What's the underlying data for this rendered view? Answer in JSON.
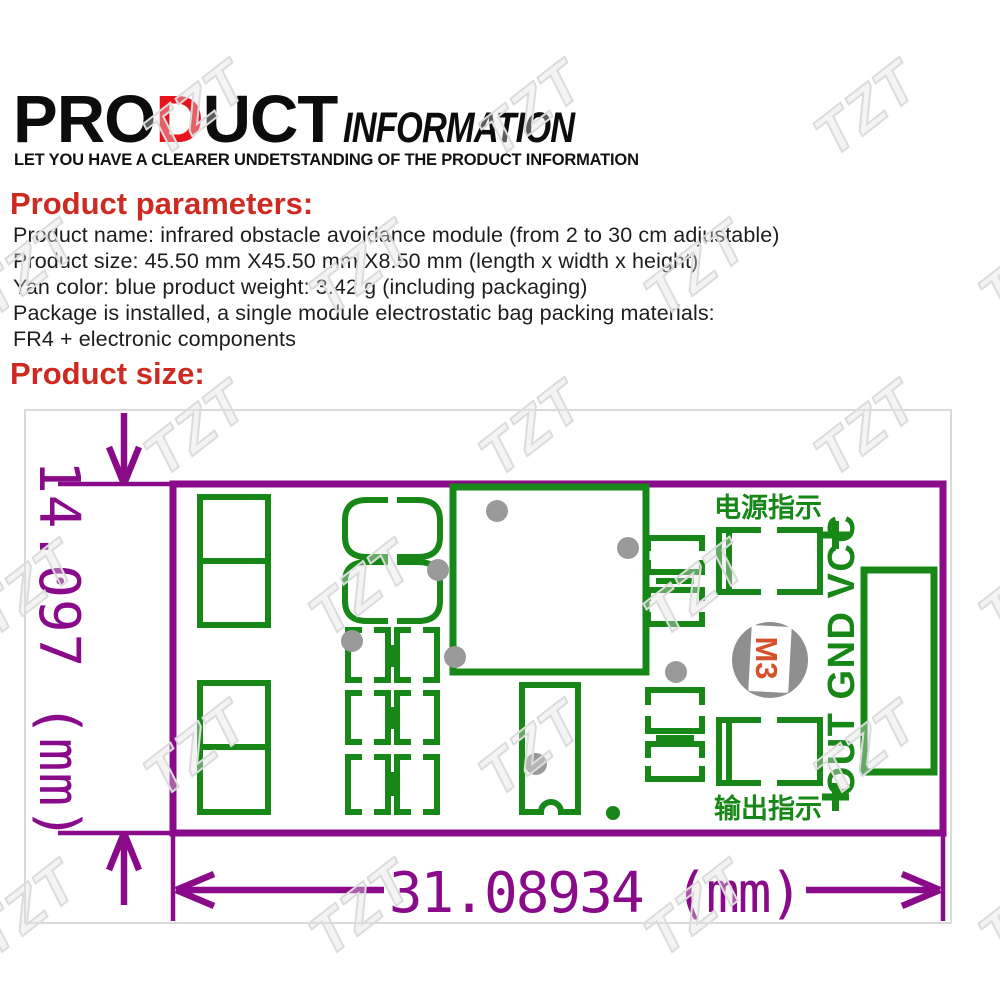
{
  "page": {
    "header": {
      "title_part1": "PRO",
      "title_accent": "D",
      "title_part2": "UCT",
      "title_secondary": "INFORMATION",
      "subtitle": "LET YOU HAVE A CLEARER UNDETSTANDING OF THE PRODUCT INFORMATION"
    },
    "parameters": {
      "heading": "Product parameters:",
      "lines": [
        "Product name: infrared obstacle avoidance module (from 2 to 30 cm adjustable)",
        "Product size: 45.50 mm X45.50 mm X8.50 mm (length x width x height)",
        "Yan color: blue product weight: 3.42 g (including packaging)",
        "Package is installed, a single module electrostatic bag packing materials:",
        "FR4 + electronic components"
      ]
    },
    "size_section": {
      "heading": "Product size:"
    },
    "diagram": {
      "height_dimension": "14.097 (mm)",
      "width_dimension": "31.08934 (mm)",
      "power_indicator_label": "电源指示",
      "output_indicator_label": "输出指示",
      "pin_labels": "OUT GND VCC",
      "mounting_hole_label": "M3",
      "plus_symbol": "+"
    },
    "watermark_text": "TZT",
    "colors": {
      "title_red": "#e8131b",
      "heading_red": "#cd2a22",
      "dimension_purple": "#8a0b8a",
      "silkscreen_green": "#178717",
      "mounting_hole_gray": "#8f8f8f",
      "m3_orange": "#d4512a",
      "via_gray": "#9a9a9a",
      "border_gray": "#dadada"
    }
  }
}
